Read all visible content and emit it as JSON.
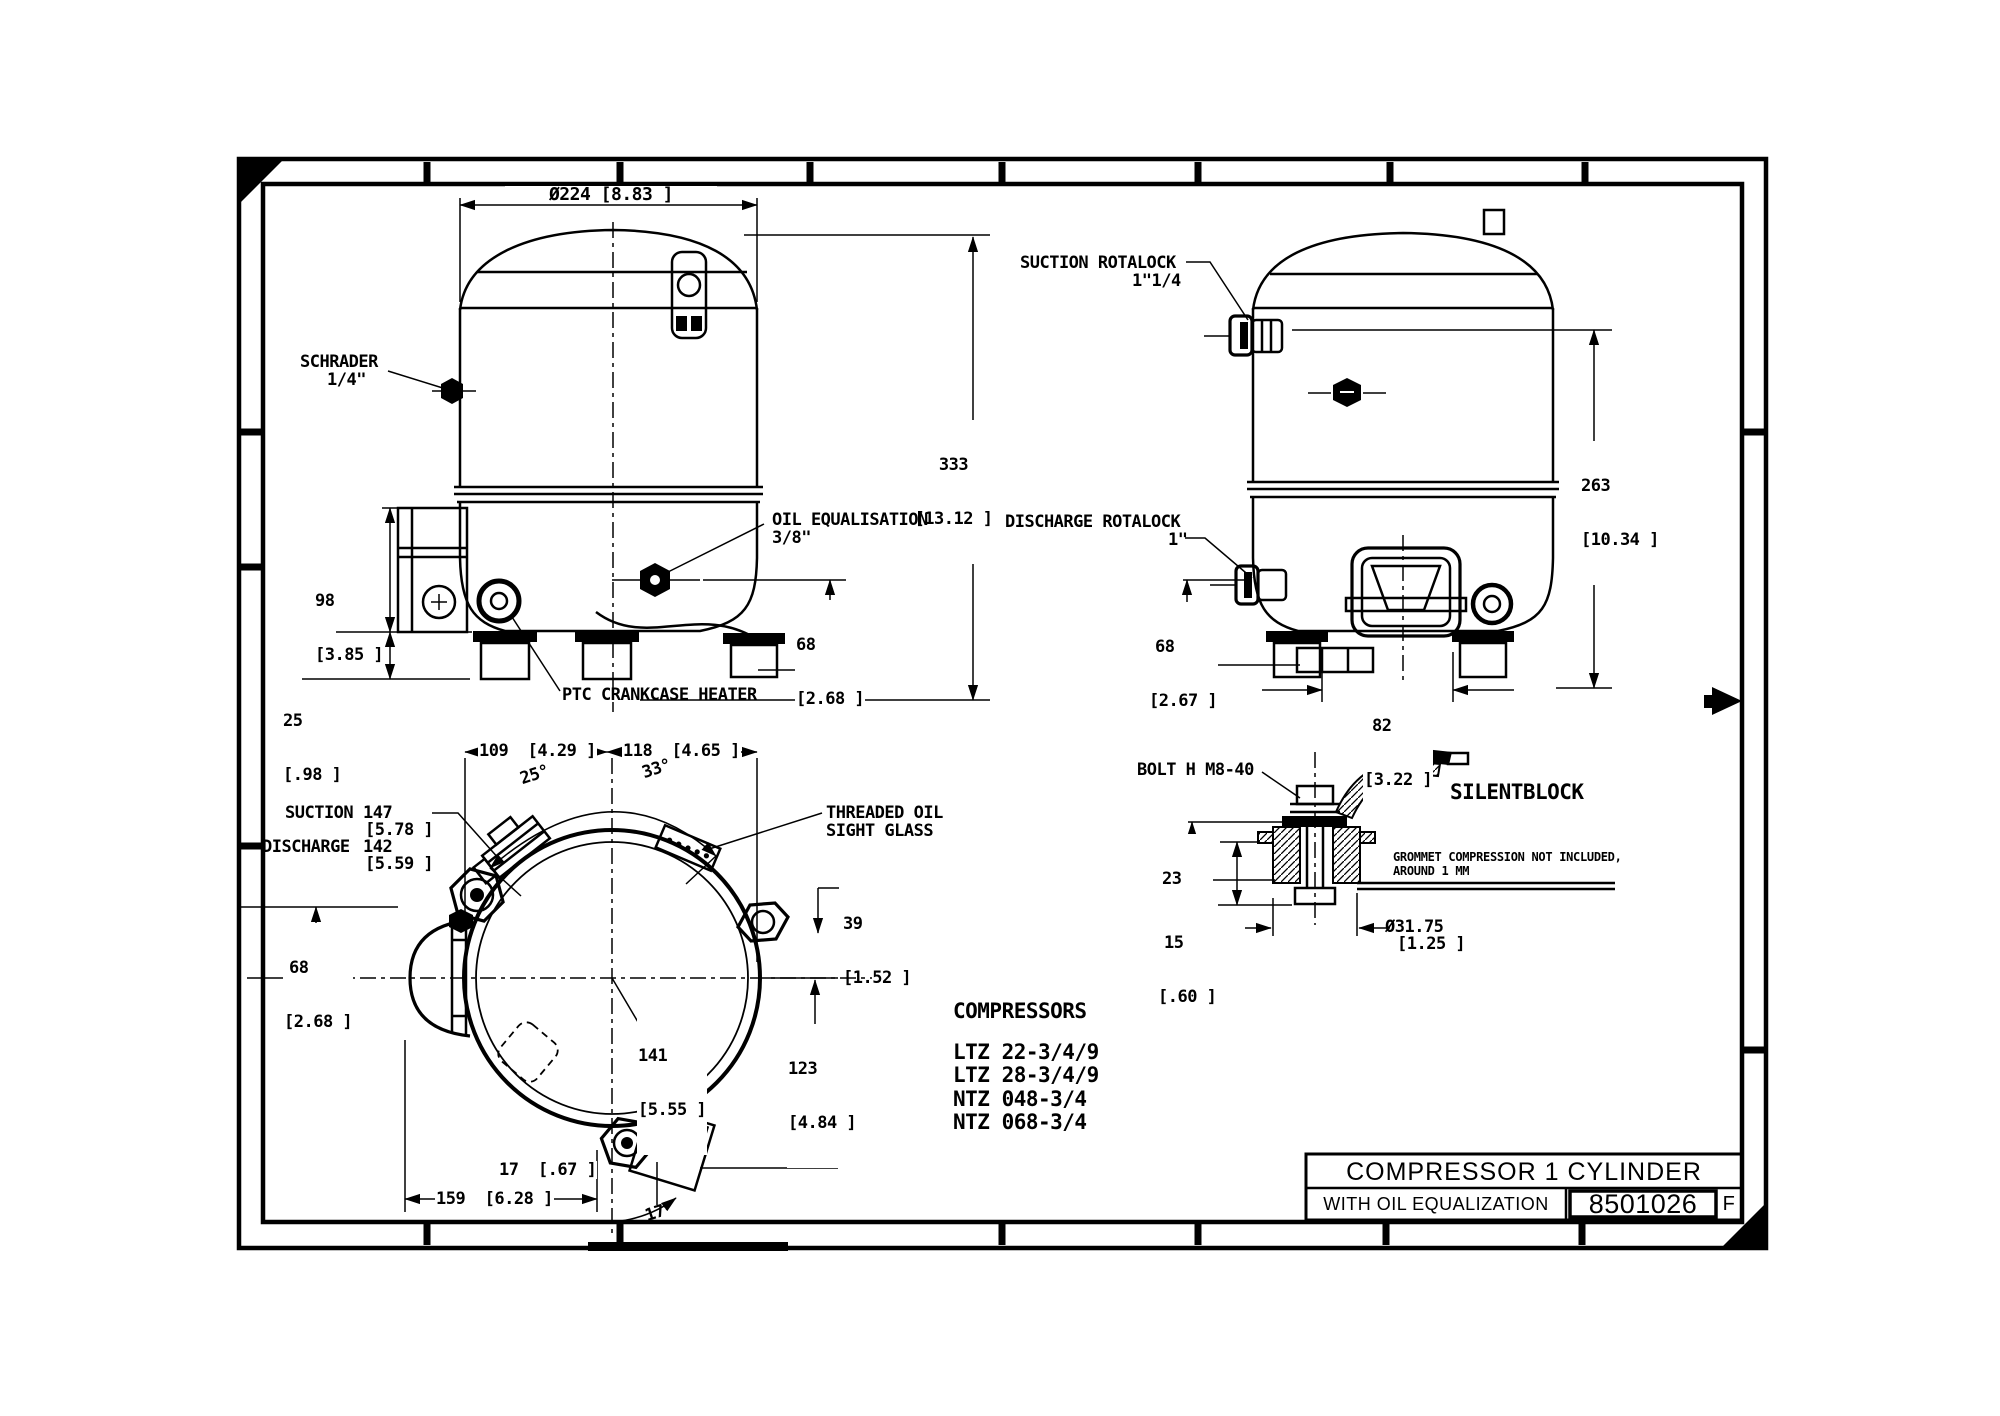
{
  "front_view": {
    "dim_diameter": "Ø224 [8.83 ]",
    "schrader": {
      "line1": "SCHRADER",
      "line2": "1/4\""
    },
    "height": {
      "mm": "333",
      "in": "[13.12 ]"
    },
    "oil_eq": {
      "line1": "OIL EQUALISATION",
      "line2": "3/8\""
    },
    "ebox_height": {
      "mm": "98",
      "in": "[3.85 ]"
    },
    "foot_height": {
      "mm": "25",
      "in": "[.98 ]"
    },
    "oil_height": {
      "mm": "68",
      "in": "[2.68 ]"
    },
    "ptc": "PTC CRANKCASE HEATER"
  },
  "side_view": {
    "suction": {
      "line1": "SUCTION ROTALOCK",
      "line2": "1\"1/4"
    },
    "discharge": {
      "line1": "DISCHARGE ROTALOCK",
      "line2": "1\""
    },
    "height": {
      "mm": "263",
      "in": "[10.34 ]"
    },
    "discharge_height": {
      "mm": "68",
      "in": "[2.67 ]"
    },
    "foot_spacing": {
      "mm": "82",
      "in": "[3.22 ]"
    }
  },
  "top_view": {
    "dim_109": "109  [4.29 ]",
    "dim_118": "118  [4.65 ]",
    "angle_25": "25°",
    "angle_33": "33°",
    "suction_label": "SUCTION",
    "suction_mm": "147",
    "suction_in": "[5.78 ]",
    "discharge_label": "DISCHARGE",
    "discharge_mm": "142",
    "discharge_in": "[5.59 ]",
    "sight_glass": {
      "line1": "THREADED OIL",
      "line2": "SIGHT GLASS"
    },
    "dim_39": {
      "mm": "39",
      "in": "[1.52 ]"
    },
    "dim_68": {
      "mm": "68",
      "in": "[2.68 ]"
    },
    "dim_141": {
      "mm": "141",
      "in": "[5.55 ]"
    },
    "dim_123": {
      "mm": "123",
      "in": "[4.84 ]"
    },
    "dim_17": "17  [.67 ]",
    "dim_159": "159  [6.28 ]",
    "angle_17": "17°"
  },
  "silentblock": {
    "bolt_label": "BOLT H M8-40",
    "title": "SILENTBLOCK",
    "dim_23": {
      "mm": "23",
      "in": "[.90 ]"
    },
    "dim_15": {
      "mm": "15",
      "in": "[.60 ]"
    },
    "note_line1": "GROMMET COMPRESSION NOT INCLUDED,",
    "note_line2": "AROUND 1 MM",
    "dim_dia": {
      "mm": "Ø31.75",
      "in": "[1.25 ]"
    }
  },
  "compressors": {
    "heading": "COMPRESSORS",
    "models": [
      "LTZ 22-3/4/9",
      "LTZ 28-3/4/9",
      "NTZ 048-3/4",
      "NTZ 068-3/4"
    ]
  },
  "title_block": {
    "title": "COMPRESSOR 1 CYLINDER",
    "subtitle": "WITH OIL EQUALIZATION",
    "drawing_number": "8501026",
    "revision": "F"
  }
}
